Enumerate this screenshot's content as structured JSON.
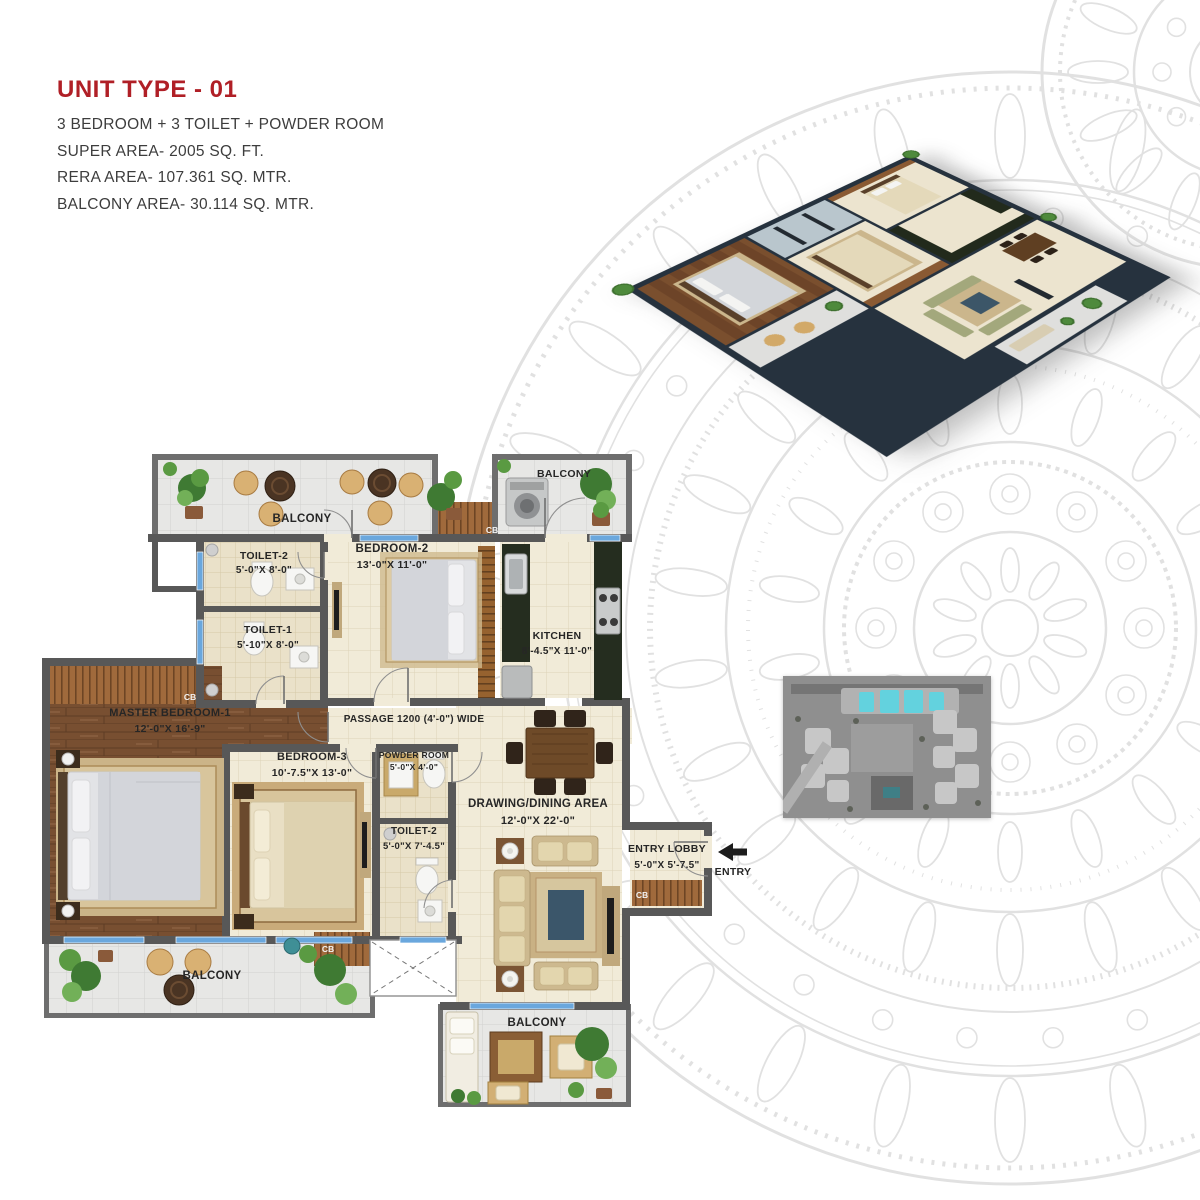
{
  "header": {
    "title": "UNIT TYPE - 01",
    "subtitle": "3 BEDROOM + 3 TOILET + POWDER ROOM",
    "super_area": "SUPER AREA- 2005 SQ. FT.",
    "rera_area": "RERA AREA- 107.361 SQ. MTR.",
    "balcony_area": "BALCONY AREA- 30.114 SQ. MTR."
  },
  "colors": {
    "title_red": "#b01f26",
    "wall_gray": "#585858",
    "window_blue": "#6aa7dd",
    "siteplan_highlight": "#63d2de",
    "mandala_gray": "#e1e1e1"
  },
  "floorplan": {
    "labels": {
      "balcony": "BALCONY",
      "passage": "PASSAGE 1200 (4'-0\") WIDE",
      "entry": "ENTRY",
      "cb": "CB"
    },
    "rooms": {
      "toilet2_top": {
        "name": "TOILET-2",
        "dims": "5'-0\"X 8'-0\""
      },
      "bedroom2": {
        "name": "BEDROOM-2",
        "dims": "13'-0\"X 11'-0\""
      },
      "kitchen": {
        "name": "KITCHEN",
        "dims": "8'-4.5\"X 11'-0\""
      },
      "toilet1": {
        "name": "TOILET-1",
        "dims": "5'-10\"X 8'-0\""
      },
      "master": {
        "name": "MASTER BEDROOM-1",
        "dims": "12'-0\"X 16'-9\""
      },
      "bedroom3": {
        "name": "BEDROOM-3",
        "dims": "10'-7.5\"X 13'-0\""
      },
      "powder": {
        "name": "POWDER ROOM",
        "dims": "5'-0\"X 4'-0\""
      },
      "toilet2_lower": {
        "name": "TOILET-2",
        "dims": "5'-0\"X 7'-4.5\""
      },
      "drawing_dining": {
        "name": "DRAWING/DINING AREA",
        "dims": "12'-0\"X 22'-0\""
      },
      "entry_lobby": {
        "name": "ENTRY LOBBY",
        "dims": "5'-0\"X 5'-7.5\""
      }
    }
  }
}
